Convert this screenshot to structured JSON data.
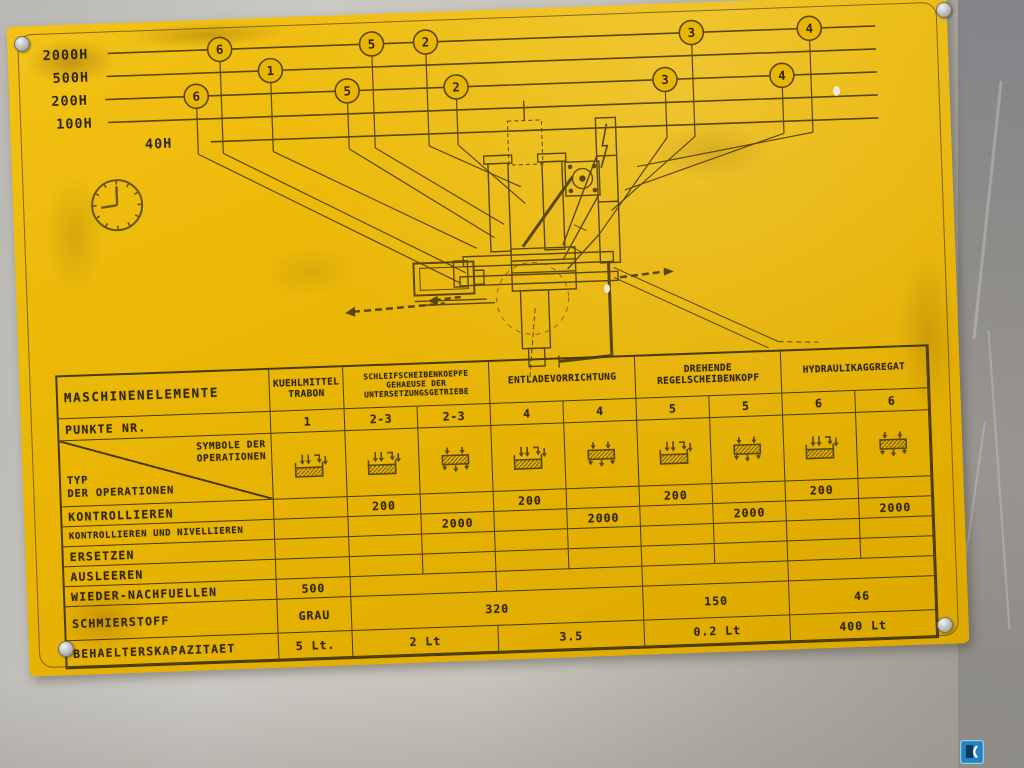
{
  "colors": {
    "plate_yellow": "#e9b606",
    "line": "#5a470e",
    "text": "#31270a",
    "table_line": "#4a3a0c",
    "logo_blue": "#2a7fc0"
  },
  "intervals": {
    "rows": [
      {
        "label": "2000H",
        "y": 30,
        "label_x": 35,
        "line_x1": 100,
        "circles": [
          {
            "n": "6",
            "x": 212
          },
          {
            "n": "5",
            "x": 364
          },
          {
            "n": "2",
            "x": 418
          },
          {
            "n": "3",
            "x": 684
          },
          {
            "n": "4",
            "x": 802
          }
        ]
      },
      {
        "label": "500H",
        "y": 53,
        "label_x": 44,
        "line_x1": 98,
        "circles": [
          {
            "n": "1",
            "x": 262
          }
        ]
      },
      {
        "label": "200H",
        "y": 76,
        "label_x": 42,
        "line_x1": 96,
        "circles": [
          {
            "n": "6",
            "x": 187
          },
          {
            "n": "5",
            "x": 338
          },
          {
            "n": "2",
            "x": 447
          },
          {
            "n": "3",
            "x": 656
          },
          {
            "n": "4",
            "x": 773
          }
        ]
      },
      {
        "label": "100H",
        "y": 99,
        "label_x": 46,
        "line_x1": 98,
        "circles": []
      },
      {
        "label": "40H",
        "y": 122,
        "label_x": 134,
        "line_x1": 200,
        "circles": []
      }
    ],
    "line_x2": 868,
    "stem_y": 134,
    "targets": {
      "2000H": [
        [
          450,
          262
        ],
        [
          490,
          215
        ],
        [
          508,
          178
        ],
        [
          598,
          205
        ],
        [
          625,
          162
        ]
      ],
      "500H": [
        [
          462,
          238
        ]
      ],
      "200H": [
        [
          444,
          272
        ],
        [
          480,
          228
        ],
        [
          512,
          195
        ],
        [
          585,
          228
        ],
        [
          612,
          185
        ]
      ],
      "100H": [],
      "40H": []
    }
  },
  "table": {
    "corner_label": "MASCHINENELEMENTE",
    "punkte_label": "PUNKTE NR.",
    "symbole_lines": [
      "SYMBOLE DER",
      "OPERATIONEN"
    ],
    "typ_lines": [
      "TYP",
      "DER OPERATIONEN"
    ],
    "groups": [
      {
        "lines": [
          "KUEHLMITTEL",
          "TRABON"
        ],
        "cols": 1,
        "punkte": [
          "1"
        ],
        "tiny": false
      },
      {
        "lines": [
          "SCHLEIFSCHEIBENKOEPFE",
          "GEHAEUSE DER",
          "UNTERSETZUNGSGETRIEBE"
        ],
        "cols": 2,
        "punkte": [
          "2-3",
          "2-3"
        ],
        "tiny": true
      },
      {
        "lines": [
          "ENTLADEVORRICHTUNG"
        ],
        "cols": 2,
        "punkte": [
          "4",
          "4"
        ],
        "tiny": false
      },
      {
        "lines": [
          "DREHENDE",
          "REGELSCHEIBENKOPF"
        ],
        "cols": 2,
        "punkte": [
          "5",
          "5"
        ],
        "tiny": false
      },
      {
        "lines": [
          "HYDRAULIKAGGREGAT"
        ],
        "cols": 2,
        "punkte": [
          "6",
          "6"
        ],
        "tiny": false
      }
    ],
    "symbols": [
      "tank-fill-icon",
      "tank-fill-icon",
      "tank-drain-icon",
      "tank-fill-icon",
      "tank-drain-icon",
      "tank-fill-icon",
      "tank-drain-icon",
      "tank-fill-icon",
      "tank-drain-icon"
    ],
    "rows": [
      {
        "label": "KONTROLLIEREN",
        "small": false,
        "cells": [
          {
            "v": "",
            "s": 1
          },
          {
            "v": "200",
            "s": 1
          },
          {
            "v": "",
            "s": 1
          },
          {
            "v": "200",
            "s": 1
          },
          {
            "v": "",
            "s": 1
          },
          {
            "v": "200",
            "s": 1
          },
          {
            "v": "",
            "s": 1
          },
          {
            "v": "200",
            "s": 1
          },
          {
            "v": "",
            "s": 1
          }
        ]
      },
      {
        "label": "KONTROLLIEREN UND NIVELLIEREN",
        "small": true,
        "cells": [
          {
            "v": "",
            "s": 1
          },
          {
            "v": "",
            "s": 1
          },
          {
            "v": "2000",
            "s": 1
          },
          {
            "v": "",
            "s": 1
          },
          {
            "v": "2000",
            "s": 1
          },
          {
            "v": "",
            "s": 1
          },
          {
            "v": "2000",
            "s": 1
          },
          {
            "v": "",
            "s": 1
          },
          {
            "v": "2000",
            "s": 1
          }
        ]
      },
      {
        "label": "ERSETZEN",
        "small": false,
        "cells": [
          {
            "v": "",
            "s": 1
          },
          {
            "v": "",
            "s": 1
          },
          {
            "v": "",
            "s": 1
          },
          {
            "v": "",
            "s": 1
          },
          {
            "v": "",
            "s": 1
          },
          {
            "v": "",
            "s": 1
          },
          {
            "v": "",
            "s": 1
          },
          {
            "v": "",
            "s": 1
          },
          {
            "v": "",
            "s": 1
          }
        ]
      },
      {
        "label": "AUSLEEREN",
        "small": false,
        "cells": [
          {
            "v": "",
            "s": 1
          },
          {
            "v": "",
            "s": 1
          },
          {
            "v": "",
            "s": 1
          },
          {
            "v": "",
            "s": 1
          },
          {
            "v": "",
            "s": 1
          },
          {
            "v": "",
            "s": 1
          },
          {
            "v": "",
            "s": 1
          },
          {
            "v": "",
            "s": 1
          },
          {
            "v": "",
            "s": 1
          }
        ]
      },
      {
        "label": "WIEDER-NACHFUELLEN",
        "small": false,
        "cells": [
          {
            "v": "500",
            "s": 1
          },
          {
            "v": "",
            "s": 2
          },
          {
            "v": "",
            "s": 2
          },
          {
            "v": "",
            "s": 2
          },
          {
            "v": "",
            "s": 2
          }
        ]
      },
      {
        "label": "SCHMIERSTOFF",
        "small": false,
        "cells": [
          {
            "v": "GRAU",
            "s": 1
          },
          {
            "v": "320",
            "s": 4
          },
          {
            "v": "150",
            "s": 2
          },
          {
            "v": "46",
            "s": 2
          }
        ]
      },
      {
        "label": "BEHAELTERSKAPAZITAET",
        "small": false,
        "cells": [
          {
            "v": "5 Lt.",
            "s": 1
          },
          {
            "v": "2 Lt",
            "s": 2
          },
          {
            "v": "3.5",
            "s": 2
          },
          {
            "v": "0.2 Lt",
            "s": 2
          },
          {
            "v": "400 Lt",
            "s": 2
          }
        ]
      }
    ]
  }
}
